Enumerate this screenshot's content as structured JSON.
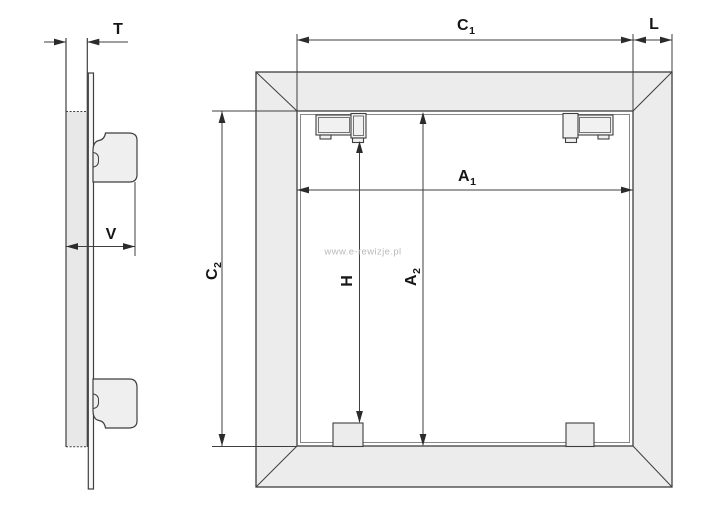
{
  "drawing": {
    "type": "technical-dimension-diagram",
    "views": {
      "side_view": {
        "description": "wall section with panel edge and two mounting clips"
      },
      "front_view": {
        "description": "square access panel frame with two top latches and two bottom stops"
      }
    }
  },
  "dimensions": {
    "t": {
      "label": "T"
    },
    "v": {
      "label": "V"
    },
    "c1": {
      "label": "C",
      "sub": "1"
    },
    "l": {
      "label": "L"
    },
    "a1": {
      "label": "A",
      "sub": "1"
    },
    "c2": {
      "label": "C",
      "sub": "2"
    },
    "h": {
      "label": "H"
    },
    "a2": {
      "label": "A",
      "sub": "2"
    }
  },
  "watermark": {
    "text": "www.e-rewizje.pl",
    "color": "#b9b9b9"
  },
  "colors": {
    "background": "#ffffff",
    "line": "#3f3f3f",
    "arrow_fill": "#2b2b2b",
    "frame_fill": "#ececec",
    "wall_fill": "#e8e8e8",
    "clip_fill": "#efefef",
    "label_text": "#161616"
  }
}
